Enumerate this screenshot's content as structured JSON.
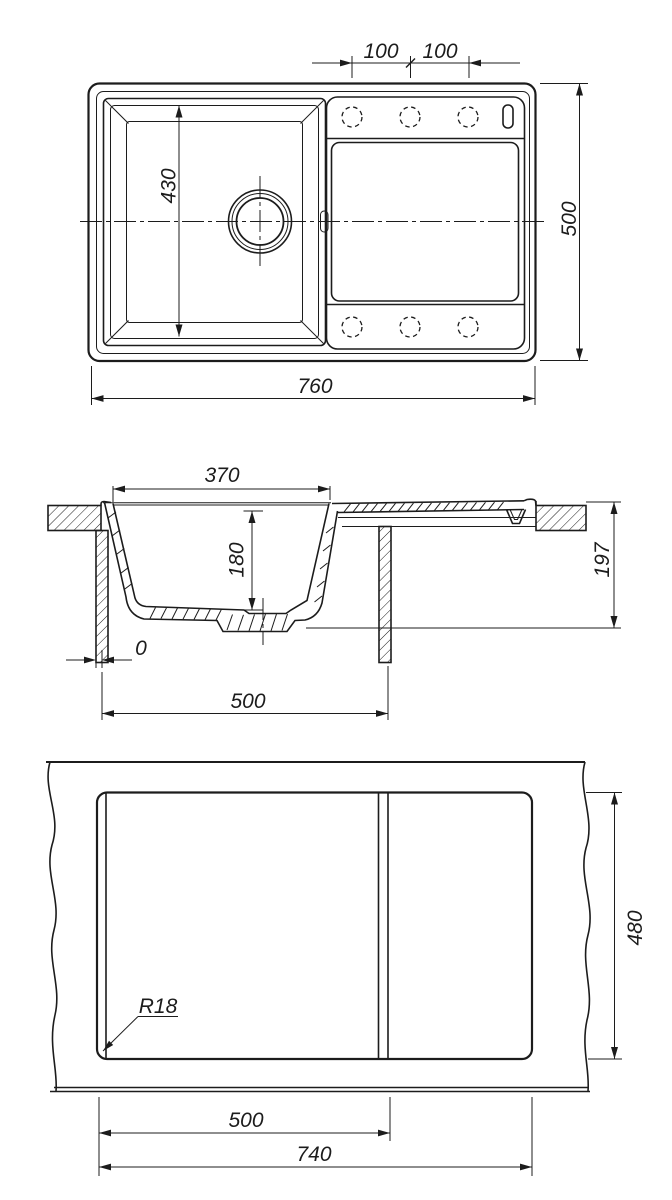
{
  "colors": {
    "line": "#1c1c1c",
    "background": "#ffffff"
  },
  "dims": {
    "plan": {
      "hole_pitch_left": "100",
      "hole_pitch_right": "100",
      "bowl_length": "430",
      "overall_length": "760",
      "overall_width": "500"
    },
    "section": {
      "bowl_width": "370",
      "bowl_depth": "180",
      "overall_height": "197",
      "front_gap": "0",
      "cabinet_width": "500"
    },
    "cutout": {
      "divider_offset": "500",
      "cutout_length": "740",
      "cutout_width": "480",
      "corner_radius": "R18"
    }
  }
}
